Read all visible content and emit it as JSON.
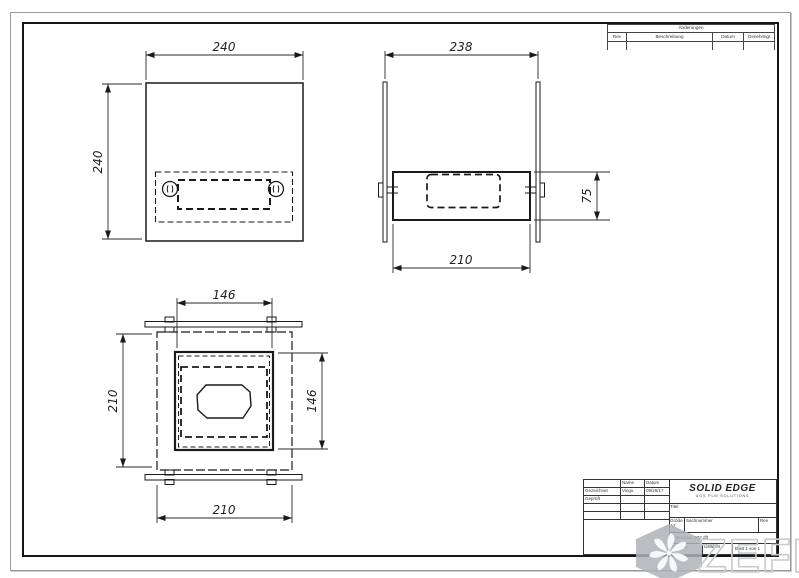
{
  "revision_table": {
    "title": "Änderungen",
    "col_rev": "Rev",
    "col_description": "Beschreibung",
    "col_date": "Datum",
    "col_approved": "Genehmigt"
  },
  "title_block": {
    "name_header": "Name",
    "date_header": "Datum",
    "drawn_label": "Gezeichnet",
    "drawn_name": "Vingu",
    "drawn_date": "09/26/17",
    "checked_label": "Geprüft",
    "logo_title": "SOLID EDGE",
    "logo_subtitle": "UGS PLM SOLUTIONS",
    "title_label": "Titel",
    "size_label": "Größe",
    "size_value": "A2",
    "doc_number_label": "Sachnummer",
    "rev_label": "Rev",
    "filename": "Dateiname: 002.dft",
    "scale_label": "Maßstab",
    "weight_label": "Gewicht",
    "sheet_label": "Blatt 1 von 1"
  },
  "dimensions": {
    "front_width": "240",
    "front_height": "240",
    "side_width": "238",
    "side_inner_width": "210",
    "side_height": "75",
    "plan_inner_width": "146",
    "plan_height": "210",
    "plan_inner_height": "146",
    "plan_width": "210"
  },
  "watermark": {
    "text": "ZEFIRE"
  },
  "colors": {
    "line": "#1a1a1a",
    "dim": "#2a2a2a",
    "watermark": "#c7cbce"
  }
}
